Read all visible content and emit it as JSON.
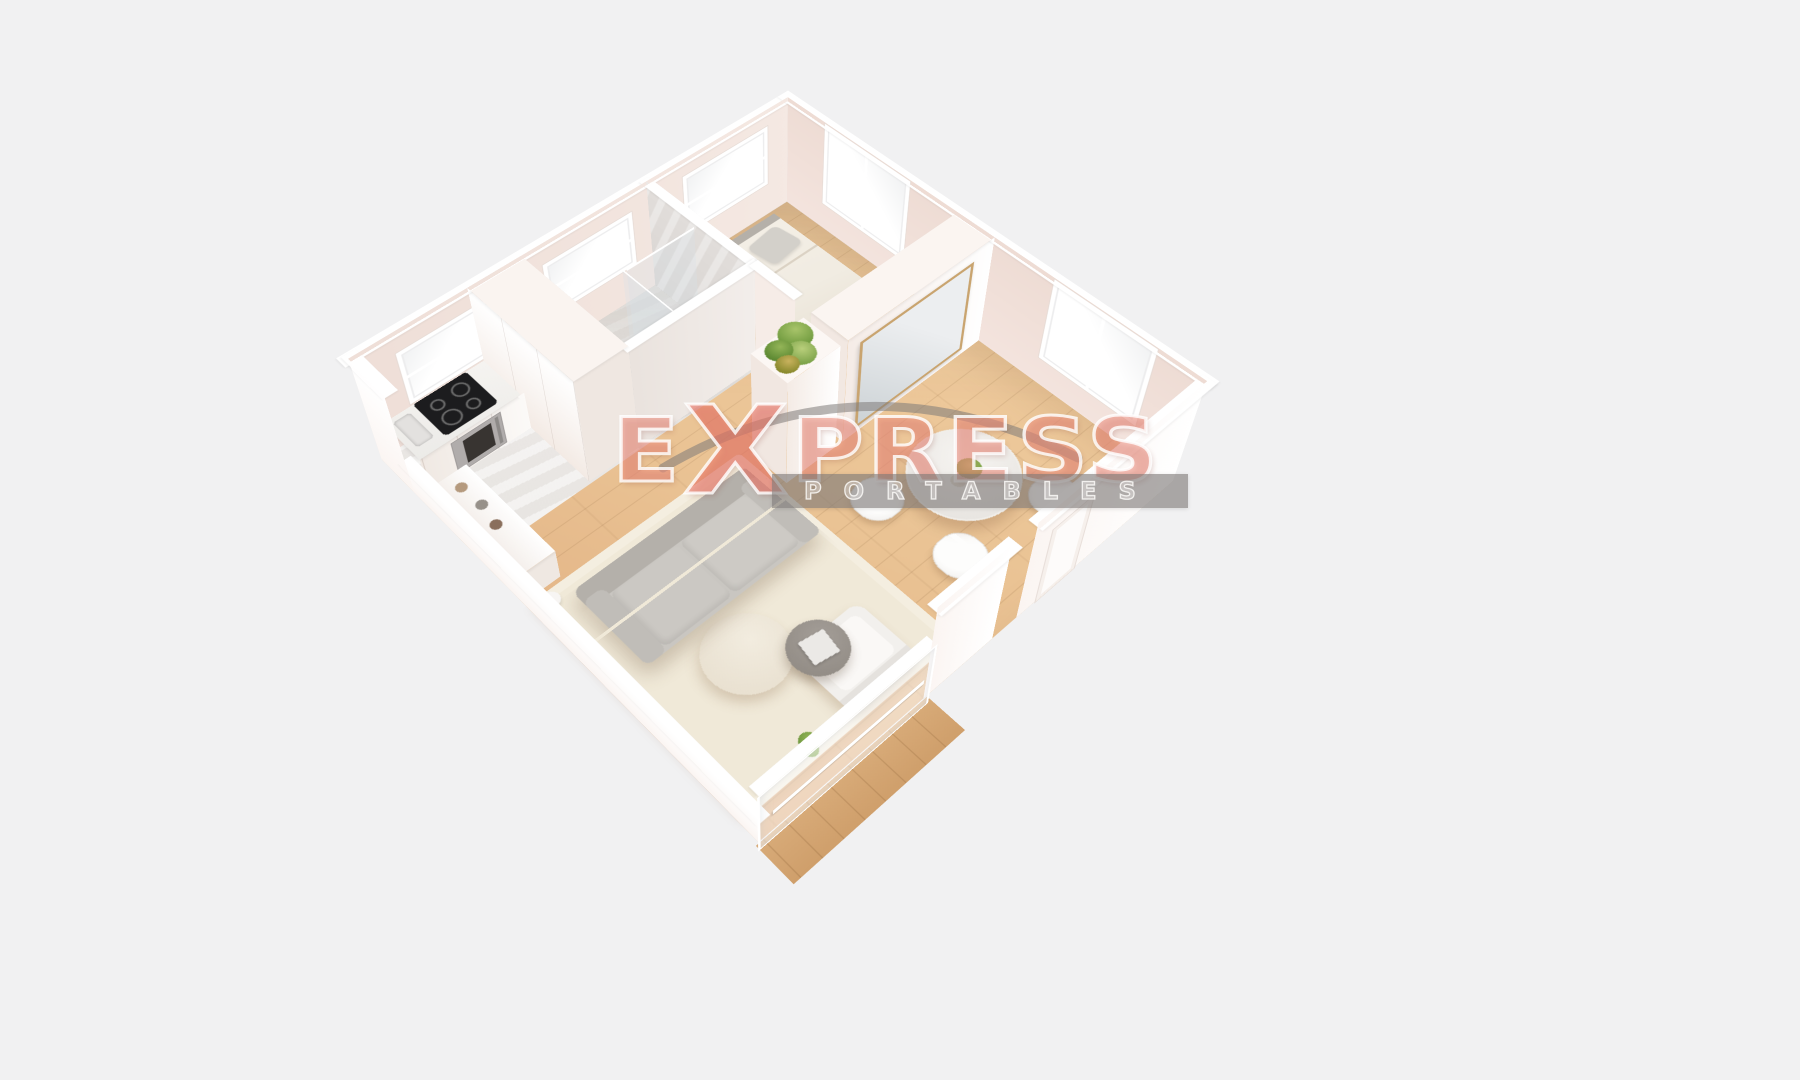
{
  "scene": {
    "type": "3d-dollhouse-floor-plan-render",
    "background_color": "#f1f1f2",
    "rooms": [
      {
        "name": "bedroom",
        "furniture": [
          "double-bed",
          "gray-headboard",
          "two-pillows",
          "window-nw",
          "window-ne"
        ]
      },
      {
        "name": "bathroom",
        "furniture": [
          "walk-in-shower",
          "glass-partition",
          "round-wall-mirror",
          "marble-walls",
          "window"
        ]
      },
      {
        "name": "kitchen",
        "furniture": [
          "marble-countertop",
          "induction-cooktop",
          "oven",
          "tall-cabinets",
          "drawer-unit",
          "sideboard-with-jars",
          "window"
        ]
      },
      {
        "name": "dining-area",
        "furniture": [
          "round-marble-table",
          "table-plant",
          "three-white-chairs",
          "window",
          "entry-door"
        ]
      },
      {
        "name": "living-room",
        "furniture": [
          "gray-two-seat-sofa",
          "cream-area-rug",
          "round-coffee-table",
          "gray-side-table-with-tray",
          "white-armchair",
          "floor-lamp",
          "potted-plant",
          "sliding-glass-door",
          "wood-deck"
        ]
      },
      {
        "name": "hallway",
        "furniture": [
          "wardrobe-with-wood-framed-mirror",
          "tall-cabinet",
          "hanging-plant"
        ]
      }
    ],
    "colors": {
      "bg": "#f1f1f2",
      "floor_wood": "#eac394",
      "floor_marble": "#e7e4e1",
      "wall_interior": "#f5e9e3",
      "wall_exterior": "#fbf5f2",
      "wall_marble": "#d9d5d2",
      "sofa": "#c9c6c1",
      "rug": "#f0e9d8",
      "bed": "#f1ece2",
      "deck": "#d8ab79",
      "plant_green": "#7da34a"
    }
  },
  "watermark": {
    "brand_full": "EXPRESS",
    "brand_e": "E",
    "brand_x": "X",
    "brand_rest": "PRESS",
    "subtitle": "PORTABLES",
    "brand": "rgba(240,145,130,0.55)",
    "band": "rgba(124,120,118,0.62)"
  }
}
